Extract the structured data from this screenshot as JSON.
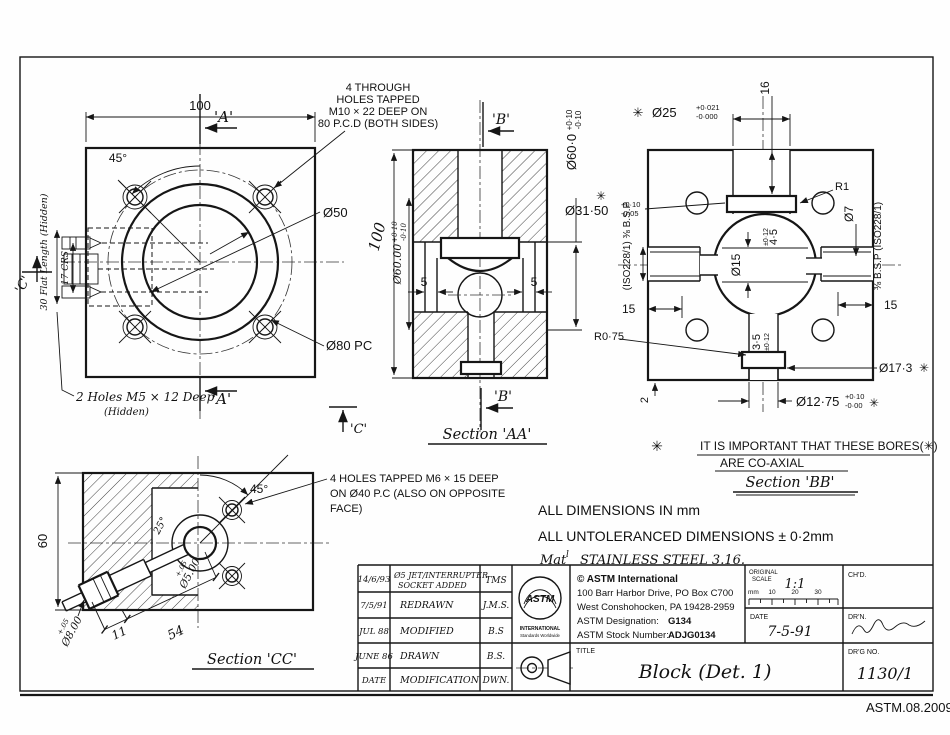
{
  "sheet": {
    "ref": "ASTM.08.2009",
    "asterisk": "✳"
  },
  "front_view": {
    "dim_width": "100",
    "angle": "45°",
    "marker_a": "'A'",
    "marker_c": "'C'",
    "bore": "Ø50",
    "pitch_circle": "Ø80 PC",
    "note_holes": [
      "4 THROUGH",
      "HOLES TAPPED",
      "M10 × 22 DEEP ON",
      "80 P.C.D (BOTH SIDES)"
    ],
    "flat_length": "30 Flat Length (Hidden)",
    "crs": "17 CRS",
    "note_m5": "2 Holes M5 × 12 Deep",
    "note_m5_sub": "(Hidden)"
  },
  "section_aa": {
    "title": "Section 'AA'",
    "marker_b": "'B'",
    "dim_height": "100",
    "bore_hw_base": "Ø60.00",
    "bore_hw_up": "+0·10",
    "bore_hw_dn": "-0·10",
    "bore_base": "Ø60·0",
    "bore_up": "+0·10",
    "bore_dn": "-0·10",
    "slot_left": "5",
    "slot_right": "5"
  },
  "section_bb": {
    "title": "Section 'BB'",
    "top_bore_base": "Ø25",
    "top_bore_up": "+0·021",
    "top_bore_dn": "-0·000",
    "dim_16": "16",
    "r1": "R1",
    "dia7": "Ø7",
    "bsp_right": "⅜ B.S.P (ISO228/1)",
    "bsp_left": "(ISO228/1) ⅜ B.S.P",
    "sphere_base": "Ø31·50",
    "sphere_up": "+0·10",
    "sphere_dn": "-0·05",
    "dia15": "Ø15",
    "dim45_base": "4·5",
    "dim45_tol": "±0·12",
    "dim35_base": "3·5",
    "dim35_tol": "±0·12",
    "dim15_left": "15",
    "dim15_right": "15",
    "r075": "R0·75",
    "dia173": "Ø17·3",
    "bot_base": "Ø12·75",
    "bot_up": "+0·10",
    "bot_dn": "-0·00",
    "dim2": "2",
    "note1": "IT IS IMPORTANT THAT THESE BORES(✳)",
    "note2": "ARE CO-AXIAL"
  },
  "section_cc": {
    "title": "Section 'CC'",
    "dim_height": "60",
    "angle": "45°",
    "socket_angle": "25°",
    "jet_tol": "+.05",
    "jet_base": "Ø5.00",
    "sock_tol": "+.05",
    "sock_base": "Ø8.00",
    "dim11": "11",
    "dim54": "54",
    "note_holes": [
      "4 HOLES TAPPED M6 × 15 DEEP",
      "ON Ø40 P.C (ALSO ON OPPOSITE",
      "FACE)"
    ]
  },
  "notes": {
    "dims": "ALL DIMENSIONS IN mm",
    "untol": "ALL UNTOLERANCED DIMENSIONS ± 0·2mm",
    "mat_prefix": "Mat",
    "mat_sup": "l",
    "material": "STAINLESS STEEL 3.16."
  },
  "revisions": {
    "rows": [
      {
        "date": "14/6/93",
        "mod1": "Ø5 JET/INTERRUPTER",
        "mod2": "SOCKET ADDED",
        "by": "TMS"
      },
      {
        "date": "7/5/91",
        "mod1": "REDRAWN",
        "mod2": "",
        "by": "J.M.S."
      },
      {
        "date": "JUL 88",
        "mod1": "MODIFIED",
        "mod2": "",
        "by": "B.S"
      },
      {
        "date": "JUNE 86",
        "mod1": "DRAWN",
        "mod2": "",
        "by": "B.S."
      },
      {
        "date": "DATE",
        "mod1": "MODIFICATION",
        "mod2": "",
        "by": "DWN."
      }
    ]
  },
  "title_block": {
    "org": "© ASTM International",
    "address1": "100 Barr Harbor Drive, PO Box C700",
    "address2": "West Conshohocken, PA  19428-2959",
    "designation_label": "ASTM Designation:",
    "designation": "G134",
    "stock_label": "ASTM Stock Number:",
    "stock": "ADJG0134",
    "logo_text": "ASTM",
    "logo_sub": "INTERNATIONAL",
    "logo_tag": "Standards Worldwide",
    "scale_label1": "ORIGINAL",
    "scale_label2": "SCALE",
    "scale_value": "1:1",
    "ruler_unit": "mm",
    "ruler_ticks": [
      "10",
      "20",
      "30"
    ],
    "chd_label": "CH'D.",
    "date_label": "DATE",
    "date_value": "7-5-91",
    "drn_label": "DR'N.",
    "drg_label": "DR'G NO.",
    "drg_value": "1130/1",
    "title_label": "TITLE",
    "title_value": "Block (Det. 1)"
  }
}
